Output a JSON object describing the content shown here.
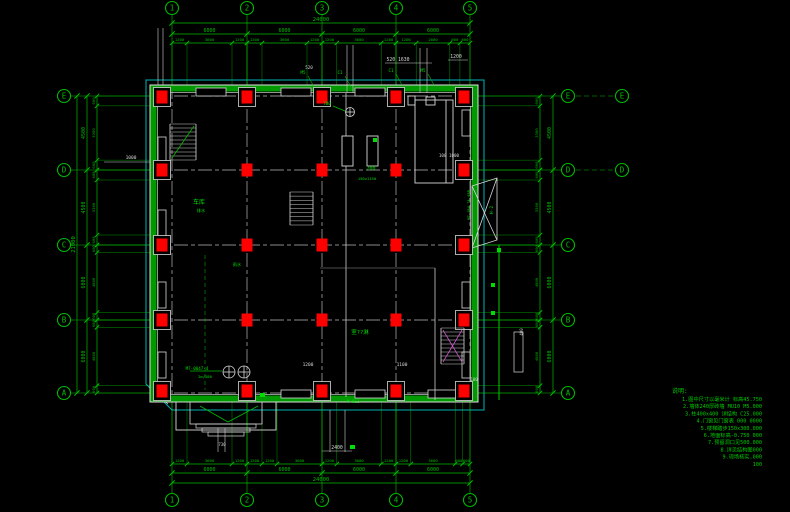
{
  "colors": {
    "dim_green": "#00bb00",
    "bright_green": "#00dd00",
    "wall_green": "#009900",
    "cyan": "#00b3b3",
    "white": "#d8d8d8",
    "gray": "#b8b8b8",
    "red": "#ff0000",
    "magenta": "#cc55cc"
  },
  "grid": {
    "cols": [
      {
        "label": "1",
        "x": 172
      },
      {
        "label": "2",
        "x": 247
      },
      {
        "label": "3",
        "x": 322
      },
      {
        "label": "4",
        "x": 396
      },
      {
        "label": "5",
        "x": 470
      }
    ],
    "rows": [
      {
        "label": "E",
        "y": 96
      },
      {
        "label": "D",
        "y": 170
      },
      {
        "label": "C",
        "y": 245
      },
      {
        "label": "B",
        "y": 320
      },
      {
        "label": "A",
        "y": 393
      }
    ]
  },
  "dims": {
    "top": {
      "total": "24000",
      "majors": [
        "6000",
        "6000",
        "6000",
        "6000"
      ],
      "minors": [
        [
          "1200",
          "3600",
          "1200"
        ],
        [
          "1200",
          "3600",
          "1200"
        ],
        [
          "1200",
          "3600",
          "1200"
        ],
        [
          "1200",
          "2000",
          "600",
          "600"
        ]
      ]
    },
    "bottom": {
      "total": "24000",
      "majors": [
        "6000",
        "6000",
        "6000",
        "6000"
      ],
      "minors": [
        [
          "1200",
          "3600",
          "1200"
        ],
        [
          "1200",
          "1200",
          "3600"
        ],
        [
          "1200",
          "3600",
          "1200"
        ],
        [
          "1200",
          "3600",
          "600",
          "600"
        ]
      ]
    },
    "left": {
      "total": "21000",
      "majors": [
        "4500",
        "4500",
        "6000",
        "6000"
      ],
      "minors": [
        [
          "600",
          "3300",
          "600"
        ],
        [
          "600",
          "3300",
          "600"
        ],
        [
          "600",
          "4800",
          "600"
        ],
        [
          "600",
          "4800",
          "600"
        ]
      ]
    },
    "right": {
      "majors": [
        "4500",
        "4500",
        "6000",
        "6000"
      ],
      "minors": [
        [
          "600",
          "3300",
          "600"
        ],
        [
          "600",
          "3300",
          "600"
        ],
        [
          "600",
          "4800",
          "600"
        ],
        [
          "600",
          "4800",
          "600"
        ]
      ]
    }
  },
  "annotations": [
    {
      "x": 398,
      "y": 61,
      "t": "520 1630",
      "c": "w",
      "s": 4.8
    },
    {
      "x": 456,
      "y": 58,
      "t": "1200",
      "c": "w",
      "s": 4.8
    },
    {
      "x": 309,
      "y": 69,
      "t": "520",
      "c": "w",
      "s": 4.2
    },
    {
      "x": 131,
      "y": 159,
      "t": "1000",
      "c": "w",
      "s": 4.5
    },
    {
      "x": 449,
      "y": 157,
      "t": "100 1000",
      "c": "w",
      "s": 4.2
    },
    {
      "x": 371,
      "y": 170,
      "t": "200",
      "c": "g",
      "s": 5
    },
    {
      "x": 367,
      "y": 180,
      "t": "150x1150",
      "c": "g",
      "s": 3.8
    },
    {
      "x": 199,
      "y": 204,
      "t": "车库",
      "c": "g",
      "s": 6
    },
    {
      "x": 201,
      "y": 212,
      "t": "排水",
      "c": "g",
      "s": 4.2
    },
    {
      "x": 237,
      "y": 266,
      "t": "雨水",
      "c": "g",
      "s": 4.2
    },
    {
      "x": 360,
      "y": 334,
      "t": "室??淋",
      "c": "g",
      "s": 5.5
    },
    {
      "x": 197,
      "y": 370,
      "t": "M7-0047-4",
      "c": "g",
      "s": 4.2
    },
    {
      "x": 205,
      "y": 378,
      "t": "2m/180",
      "c": "g",
      "s": 3.8
    },
    {
      "x": 353,
      "y": 403,
      "t": "M-812",
      "c": "g",
      "s": 4.2
    },
    {
      "x": 308,
      "y": 366,
      "t": "1200",
      "c": "w",
      "s": 4.5
    },
    {
      "x": 402,
      "y": 366,
      "t": "1100",
      "c": "w",
      "s": 4.5
    },
    {
      "x": 474,
      "y": 381,
      "t": "100",
      "c": "w",
      "s": 4
    },
    {
      "x": 337,
      "y": 449,
      "t": "2400",
      "c": "w",
      "s": 4.8
    },
    {
      "x": 222,
      "y": 446,
      "t": "730",
      "c": "w",
      "s": 4
    },
    {
      "x": 470,
      "y": 205,
      "t": "M7-184 7A-43B",
      "c": "g",
      "s": 3.8,
      "r": -90
    },
    {
      "x": 493,
      "y": 210,
      "t": "H-2",
      "c": "g",
      "s": 4.5,
      "r": -90
    },
    {
      "x": 327,
      "y": 105,
      "t": "700",
      "c": "g",
      "s": 4.2
    },
    {
      "x": 523,
      "y": 332,
      "t": "400",
      "c": "w",
      "s": 4,
      "r": -90
    }
  ],
  "tags": [
    {
      "x": 303,
      "y": 74,
      "t": "M5"
    },
    {
      "x": 340,
      "y": 74,
      "t": "C1"
    },
    {
      "x": 391,
      "y": 72,
      "t": "C1"
    },
    {
      "x": 423,
      "y": 72,
      "t": "M5"
    }
  ],
  "extra_bubbles": [
    {
      "label": "E",
      "x": 622,
      "y": 96
    },
    {
      "label": "D",
      "x": 622,
      "y": 170
    }
  ],
  "notes": {
    "header": "说明:",
    "lines": [
      "1.图中尺寸以毫米计 标高45.750",
      "2.墙体240厚砖墙 MU10 M5.000",
      "3.柱400x400 详结构 C25.000",
      "4.门窗见门窗表 000 0000",
      "5.楼梯踏步150x300.000",
      "6.地面标高-0.750 000",
      "7.预留洞口见500.000",
      "8.详见结构图000",
      "9.现场核实.000",
      "100"
    ]
  }
}
